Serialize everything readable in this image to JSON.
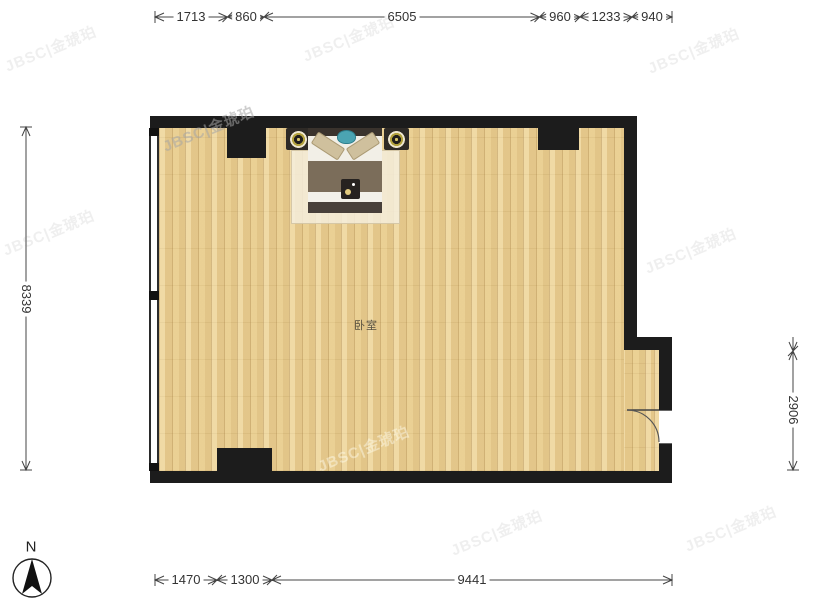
{
  "page": {
    "background": "#ffffff"
  },
  "watermark": {
    "text": "JBSC|金琥珀"
  },
  "compass": {
    "north_label": "N"
  },
  "plan": {
    "room_label": "卧室",
    "wall_color": "#1c1c1c",
    "floor_color": "#e9cf94"
  },
  "dimensions": {
    "unit": "mm",
    "top": [
      "1713",
      "860",
      "6505",
      "960",
      "1233",
      "940"
    ],
    "bottom": [
      "1470",
      "1300",
      "9441"
    ],
    "left": [
      "8339"
    ],
    "right": [
      "5433",
      "2906"
    ]
  }
}
